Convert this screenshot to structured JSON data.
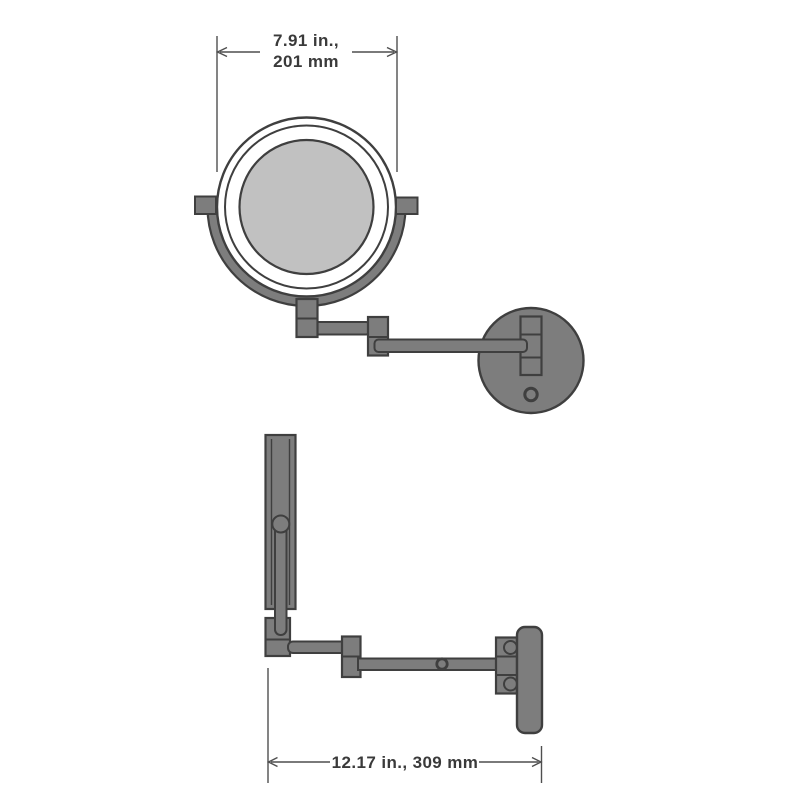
{
  "front_view": {
    "name": "front view - wall mirror",
    "dimension": {
      "label_line1": "7.91 in.,",
      "label_line2": "201 mm"
    }
  },
  "side_view": {
    "name": "side view - extended arm",
    "dimension": {
      "label": "12.17 in., 309 mm"
    }
  },
  "colors": {
    "background": "#ffffff",
    "metal_gray": "#7d7d7d",
    "mirror_glass_gray": "#c1c1c1",
    "outline_dark": "#3f3f3f",
    "dimension_line": "#4f4f4f",
    "text": "#3a3a3a"
  }
}
